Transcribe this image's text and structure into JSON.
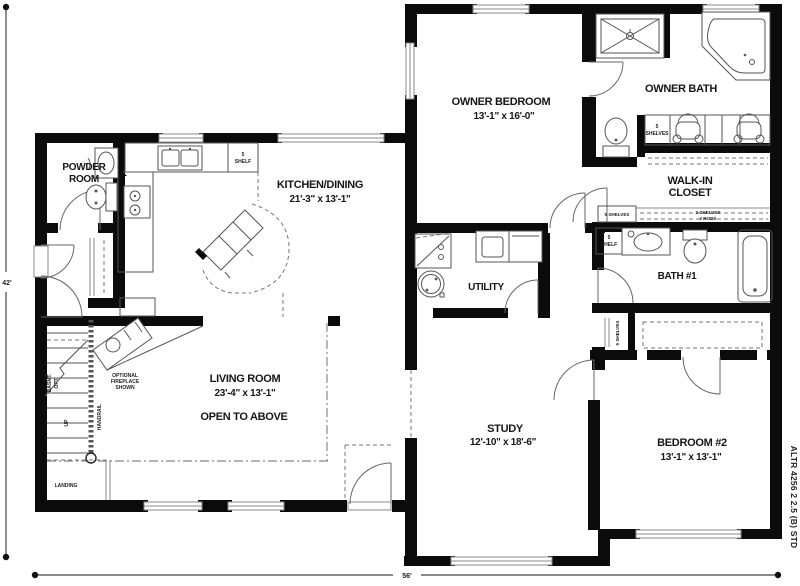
{
  "rooms": {
    "powder": {
      "line1": "POWDER",
      "line2": "ROOM"
    },
    "kitchen": {
      "name": "KITCHEN/DINING",
      "dims": "21'-3\" x 13'-1\""
    },
    "owner_bedroom": {
      "name": "OWNER BEDROOM",
      "dims": "13'-1\" x 16'-0\""
    },
    "owner_bath": {
      "name": "OWNER BATH"
    },
    "walkin_closet": {
      "line1": "WALK-IN",
      "line2": "CLOSET"
    },
    "bath1": {
      "name": "BATH #1"
    },
    "utility": {
      "name": "UTILITY"
    },
    "living": {
      "name": "LIVING ROOM",
      "dims": "23'-4\" x 13'-1\"",
      "note": "OPEN TO ABOVE"
    },
    "study": {
      "name": "STUDY",
      "dims": "12'-10\" x 18'-6\""
    },
    "bedroom2": {
      "name": "BEDROOM #2",
      "dims": "13'-1\" x 13'-1\""
    }
  },
  "closets": {
    "pantry": {
      "line1": "5",
      "line2": "SHELF"
    },
    "owner_bath_shelves": {
      "line1": "5",
      "line2": "SHELVES"
    },
    "wic_left": "5 SHELVES",
    "wic_right": {
      "line1": "2 SHELVES",
      "line2": "2 RODS"
    },
    "bath1_shelf": {
      "line1": "5",
      "line2": "SHELF"
    },
    "hall_closet": "5 SHELVES"
  },
  "stairs": {
    "basement": "BASMT.",
    "opt": "OPT.",
    "up": "UP",
    "handrail": "HANDRAIL",
    "landing": "LANDING"
  },
  "fireplace": {
    "line1": "OPTIONAL",
    "line2": "FIREPLACE",
    "line3": "SHOWN"
  },
  "dimensions": {
    "height": "42'",
    "width": "56'"
  },
  "plan_number": "ALTR 4256 2 2.5 (B) STD"
}
